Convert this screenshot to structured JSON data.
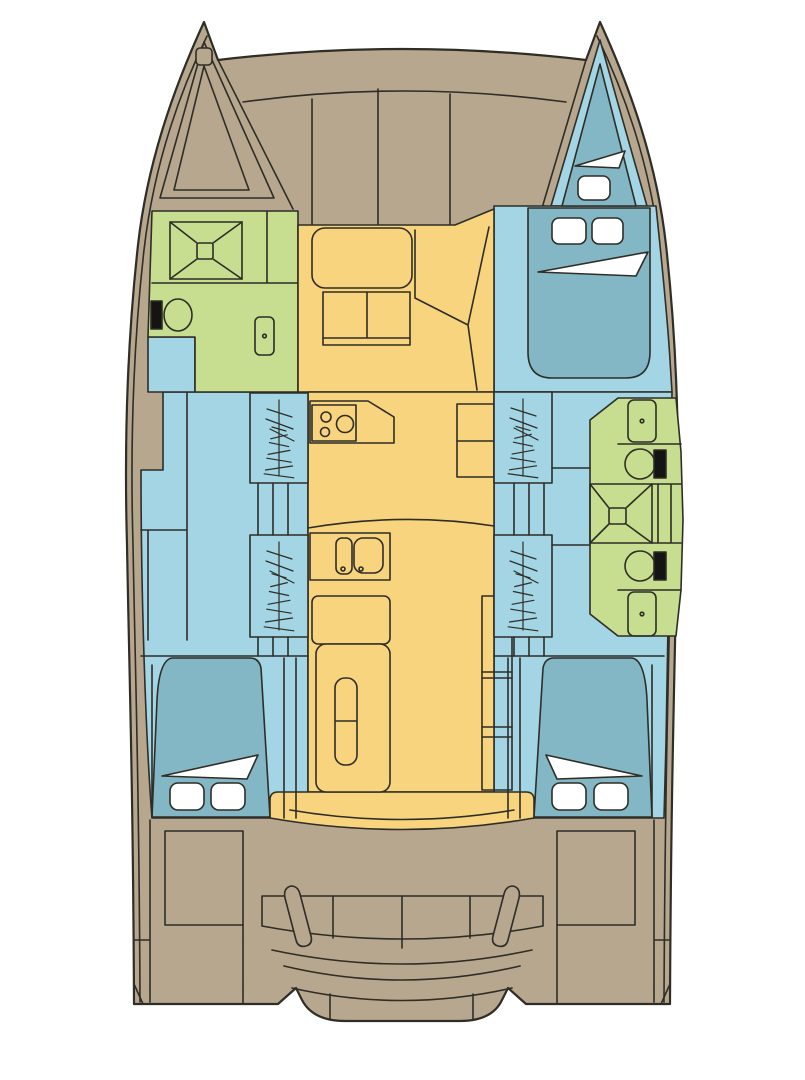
{
  "page": {
    "background": "#ffffff"
  },
  "colors": {
    "outline": "#2e2d26",
    "deck": "#b7a78f",
    "hull_interior": "#a3d5e5",
    "berth": "#83b7c5",
    "wet_area": "#c7dd8f",
    "saloon": "#f8d47e",
    "fixture_white": "#ffffff",
    "fixture_black": "#141414"
  },
  "areas": [
    {
      "id": "foredeck",
      "color": "deck"
    },
    {
      "id": "port-bow-anchor-locker",
      "color": "deck"
    },
    {
      "id": "starboard-bow-berth",
      "color": "berth"
    },
    {
      "id": "port-forward-bathroom",
      "color": "wet_area"
    },
    {
      "id": "starboard-aft-bathrooms",
      "color": "wet_area"
    },
    {
      "id": "saloon-galley",
      "color": "saloon"
    },
    {
      "id": "port-hull",
      "color": "hull_interior"
    },
    {
      "id": "starboard-hull",
      "color": "hull_interior"
    },
    {
      "id": "port-aft-cabin-berth",
      "color": "berth"
    },
    {
      "id": "starboard-aft-cabin-berth",
      "color": "berth"
    },
    {
      "id": "aft-cockpit",
      "color": "deck"
    }
  ]
}
